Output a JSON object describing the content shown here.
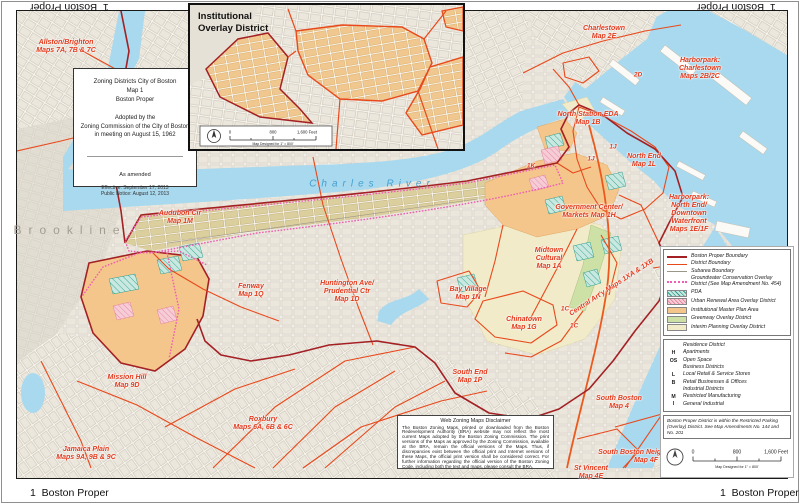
{
  "page": {
    "corner_label": "1  Boston Proper"
  },
  "title_box": {
    "line1": "Zoning Districts City of Boston",
    "line2": "Map 1",
    "line3": "Boston Proper",
    "adopted1": "Adopted by the",
    "adopted2": "Zoning Commission of the City of Boston",
    "adopted3": "in meeting on August 15, 1962",
    "amended": "As amended",
    "effective": "Effective: September 17, 2013",
    "notice": "Public Notice: August 12, 2013"
  },
  "inset": {
    "title_line1": "Institutional",
    "title_line2": "Overlay District",
    "scale": {
      "start": "0",
      "mid": "800",
      "end": "1,600 Feet",
      "note": "Map Designed for 1\" = 800'"
    }
  },
  "place_labels": {
    "brookline": "Brookline",
    "charles_river": "Charles River"
  },
  "map_labels": [
    {
      "id": "allston-brighton",
      "text": "Allston/Brighton\nMaps 7A, 7B & 7C",
      "x": 66,
      "y": 47
    },
    {
      "id": "charlestown",
      "text": "Charlestown\nMap 2E",
      "x": 604,
      "y": 33
    },
    {
      "id": "harborpark-charlestown",
      "text": "Harborpark:\nCharlestown\nMaps 2B/2C",
      "x": 700,
      "y": 69
    },
    {
      "id": "north-station-eda",
      "text": "North Station EDA\nMap 1B",
      "x": 588,
      "y": 119
    },
    {
      "id": "north-end",
      "text": "North End\nMap 1L",
      "x": 644,
      "y": 161
    },
    {
      "id": "code-1k",
      "text": "1K",
      "x": 531,
      "y": 166,
      "small": true
    },
    {
      "id": "code-1j-a",
      "text": "1J",
      "x": 613,
      "y": 147,
      "small": true
    },
    {
      "id": "code-1j-b",
      "text": "1J",
      "x": 591,
      "y": 159,
      "small": true
    },
    {
      "id": "code-2d",
      "text": "2D",
      "x": 638,
      "y": 75,
      "small": true
    },
    {
      "id": "government-center",
      "text": "Government Center/\nMarkets Map 1H",
      "x": 589,
      "y": 212
    },
    {
      "id": "harborpark-north-end",
      "text": "Harborpark:\nNorth End/\nDowntown\nWaterfront\nMaps 1E/1F",
      "x": 689,
      "y": 214
    },
    {
      "id": "audubon-cir",
      "text": "Audubon Cir\nMap 1M",
      "x": 180,
      "y": 218
    },
    {
      "id": "midtown-cultural",
      "text": "Midtown\nCultural\nMap 1A",
      "x": 549,
      "y": 259
    },
    {
      "id": "bay-village",
      "text": "Bay Village\nMap 1N",
      "x": 468,
      "y": 294
    },
    {
      "id": "fenway",
      "text": "Fenway\nMap 1Q",
      "x": 251,
      "y": 291
    },
    {
      "id": "huntington",
      "text": "Huntington Ave/\nPrudential Ctr\nMap 1D",
      "x": 347,
      "y": 292
    },
    {
      "id": "chinatown",
      "text": "Chinatown\nMap 1G",
      "x": 524,
      "y": 324
    },
    {
      "id": "code-1c-a",
      "text": "1C",
      "x": 565,
      "y": 309,
      "small": true
    },
    {
      "id": "code-1c-b",
      "text": "1C",
      "x": 574,
      "y": 326,
      "small": true
    },
    {
      "id": "central-artery",
      "text": "Central Art'y Maps 1XA & 1XB",
      "x": 612,
      "y": 288,
      "rotate": -33
    },
    {
      "id": "mission-hill",
      "text": "Mission Hill\nMap 9D",
      "x": 127,
      "y": 382
    },
    {
      "id": "south-end",
      "text": "South End\nMap 1P",
      "x": 470,
      "y": 377
    },
    {
      "id": "roxbury",
      "text": "Roxbury\nMaps 6A, 6B & 6C",
      "x": 263,
      "y": 424
    },
    {
      "id": "jamaica-plain",
      "text": "Jamaica Plain\nMaps 9A, 9B & 9C",
      "x": 86,
      "y": 454
    },
    {
      "id": "south-boston",
      "text": "South Boston\nMap 4",
      "x": 619,
      "y": 403
    },
    {
      "id": "south-boston-neighborhood",
      "text": "South Boston Neighborhood\nMap 4F",
      "x": 646,
      "y": 457
    },
    {
      "id": "st-vincent",
      "text": "St Vincent\nMap 4E",
      "x": 591,
      "y": 473
    }
  ],
  "legend": {
    "overlay_items": [
      {
        "label": "Boston Proper Boundary",
        "swatch": "sw-line-proper"
      },
      {
        "label": "District Boundary",
        "swatch": "sw-line-district"
      },
      {
        "label": "Subarea Boundary",
        "swatch": "sw-line-subarea"
      },
      {
        "label": "Groundwater Conservation Overlay District (See Map Amendment No. 454)",
        "swatch": "sw-dot-groundwater"
      },
      {
        "label": "PDA",
        "swatch": "sw-hatch-pda"
      },
      {
        "label": "Urban Renewal Area Overlay District",
        "swatch": "sw-hatch-urban"
      },
      {
        "label": "Institutional Master Plan Area",
        "swatch": "sw-fill-institutional"
      },
      {
        "label": "Greenway Overlay District",
        "swatch": "sw-fill-greenway"
      },
      {
        "label": "Interim Planning Overlay District",
        "swatch": "sw-fill-ipod"
      }
    ],
    "district_groups": [
      {
        "header": "Residence District",
        "items": [
          {
            "code": "H",
            "label": "Apartments"
          },
          {
            "code": "OS",
            "label": "Open Space"
          }
        ]
      },
      {
        "header": "Business Districts",
        "items": [
          {
            "code": "L",
            "label": "Local Retail & Service Stores"
          },
          {
            "code": "B",
            "label": "Retail Businesses & Offices"
          }
        ]
      },
      {
        "header": "Industrial Districts",
        "items": [
          {
            "code": "M",
            "label": "Restricted Manufacturing"
          },
          {
            "code": "I",
            "label": "General Industrial"
          }
        ]
      }
    ],
    "note": "Boston Proper District is within the Restricted Parking (Overlay) District. See Map Amendments No. 144 and No. 201",
    "scale": {
      "start": "0",
      "mid": "800",
      "end": "1,600 Feet",
      "note": "Map Designed for 1\" = 800'"
    }
  },
  "disclaimer": {
    "title": "Web Zoning Maps Disclaimer",
    "body": "The Boston Zoning Maps, printed or downloaded from the Boston Redevelopment Authority (BRA) website may not reflect the most current Maps adopted by the Boston Zoning Commission. The print versions of the Maps as approved by the Zoning Commission, available at the BRA, remain the official versions of the Maps. Thus, if discrepancies exist between the official print and Internet versions of these Maps, the official print version shall be considered correct. For further information regarding the official version of the Boston Zoning Code, including both the text and maps, please consult the BRA."
  },
  "colors": {
    "boston_proper_boundary": "#a32024",
    "district_boundary": "#e8491c",
    "groundwater_overlay": "#ee5eb2",
    "water": "#a9d9ee",
    "institutional_orange": "#f4c68c",
    "greenway_green": "#cde0a6",
    "ipod_cream": "#f1ebc9",
    "label_red": "#e2391b"
  }
}
